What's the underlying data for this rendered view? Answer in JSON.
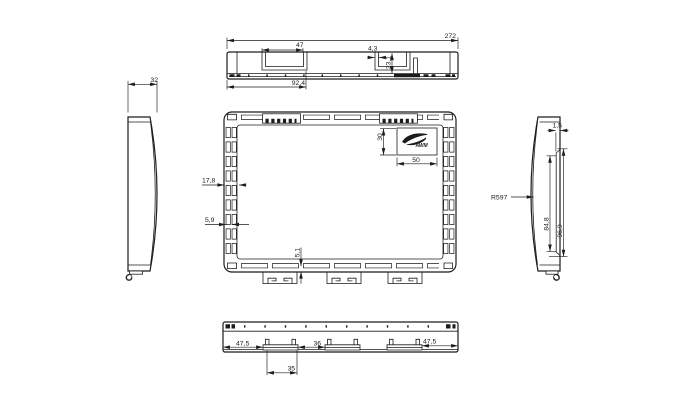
{
  "colors": {
    "background": "#ffffff",
    "line": "#1c1c1c",
    "text": "#1c1c1c"
  },
  "logo": {
    "text": "AWM"
  },
  "views": {
    "top": {
      "dims": {
        "overall_width": "272",
        "recess_width": "47",
        "notch": "4,3",
        "depth": "23,1",
        "recess_offset": "92,4"
      }
    },
    "left": {
      "dims": {
        "thickness": "32"
      }
    },
    "front": {
      "dims": {
        "border_width": "17,8",
        "slot_width": "5,9",
        "tab_gap": "5,1",
        "logo_height": "30",
        "logo_width": "50"
      }
    },
    "right": {
      "dims": {
        "radius": "R597",
        "edge_gap": "1,5",
        "inner_height": "84,8",
        "outer_height": "96,9"
      }
    },
    "bottom": {
      "dims": {
        "left_offset": "47,5",
        "center_gap": "36",
        "right_offset": "47,5",
        "tab_width": "35"
      }
    }
  }
}
